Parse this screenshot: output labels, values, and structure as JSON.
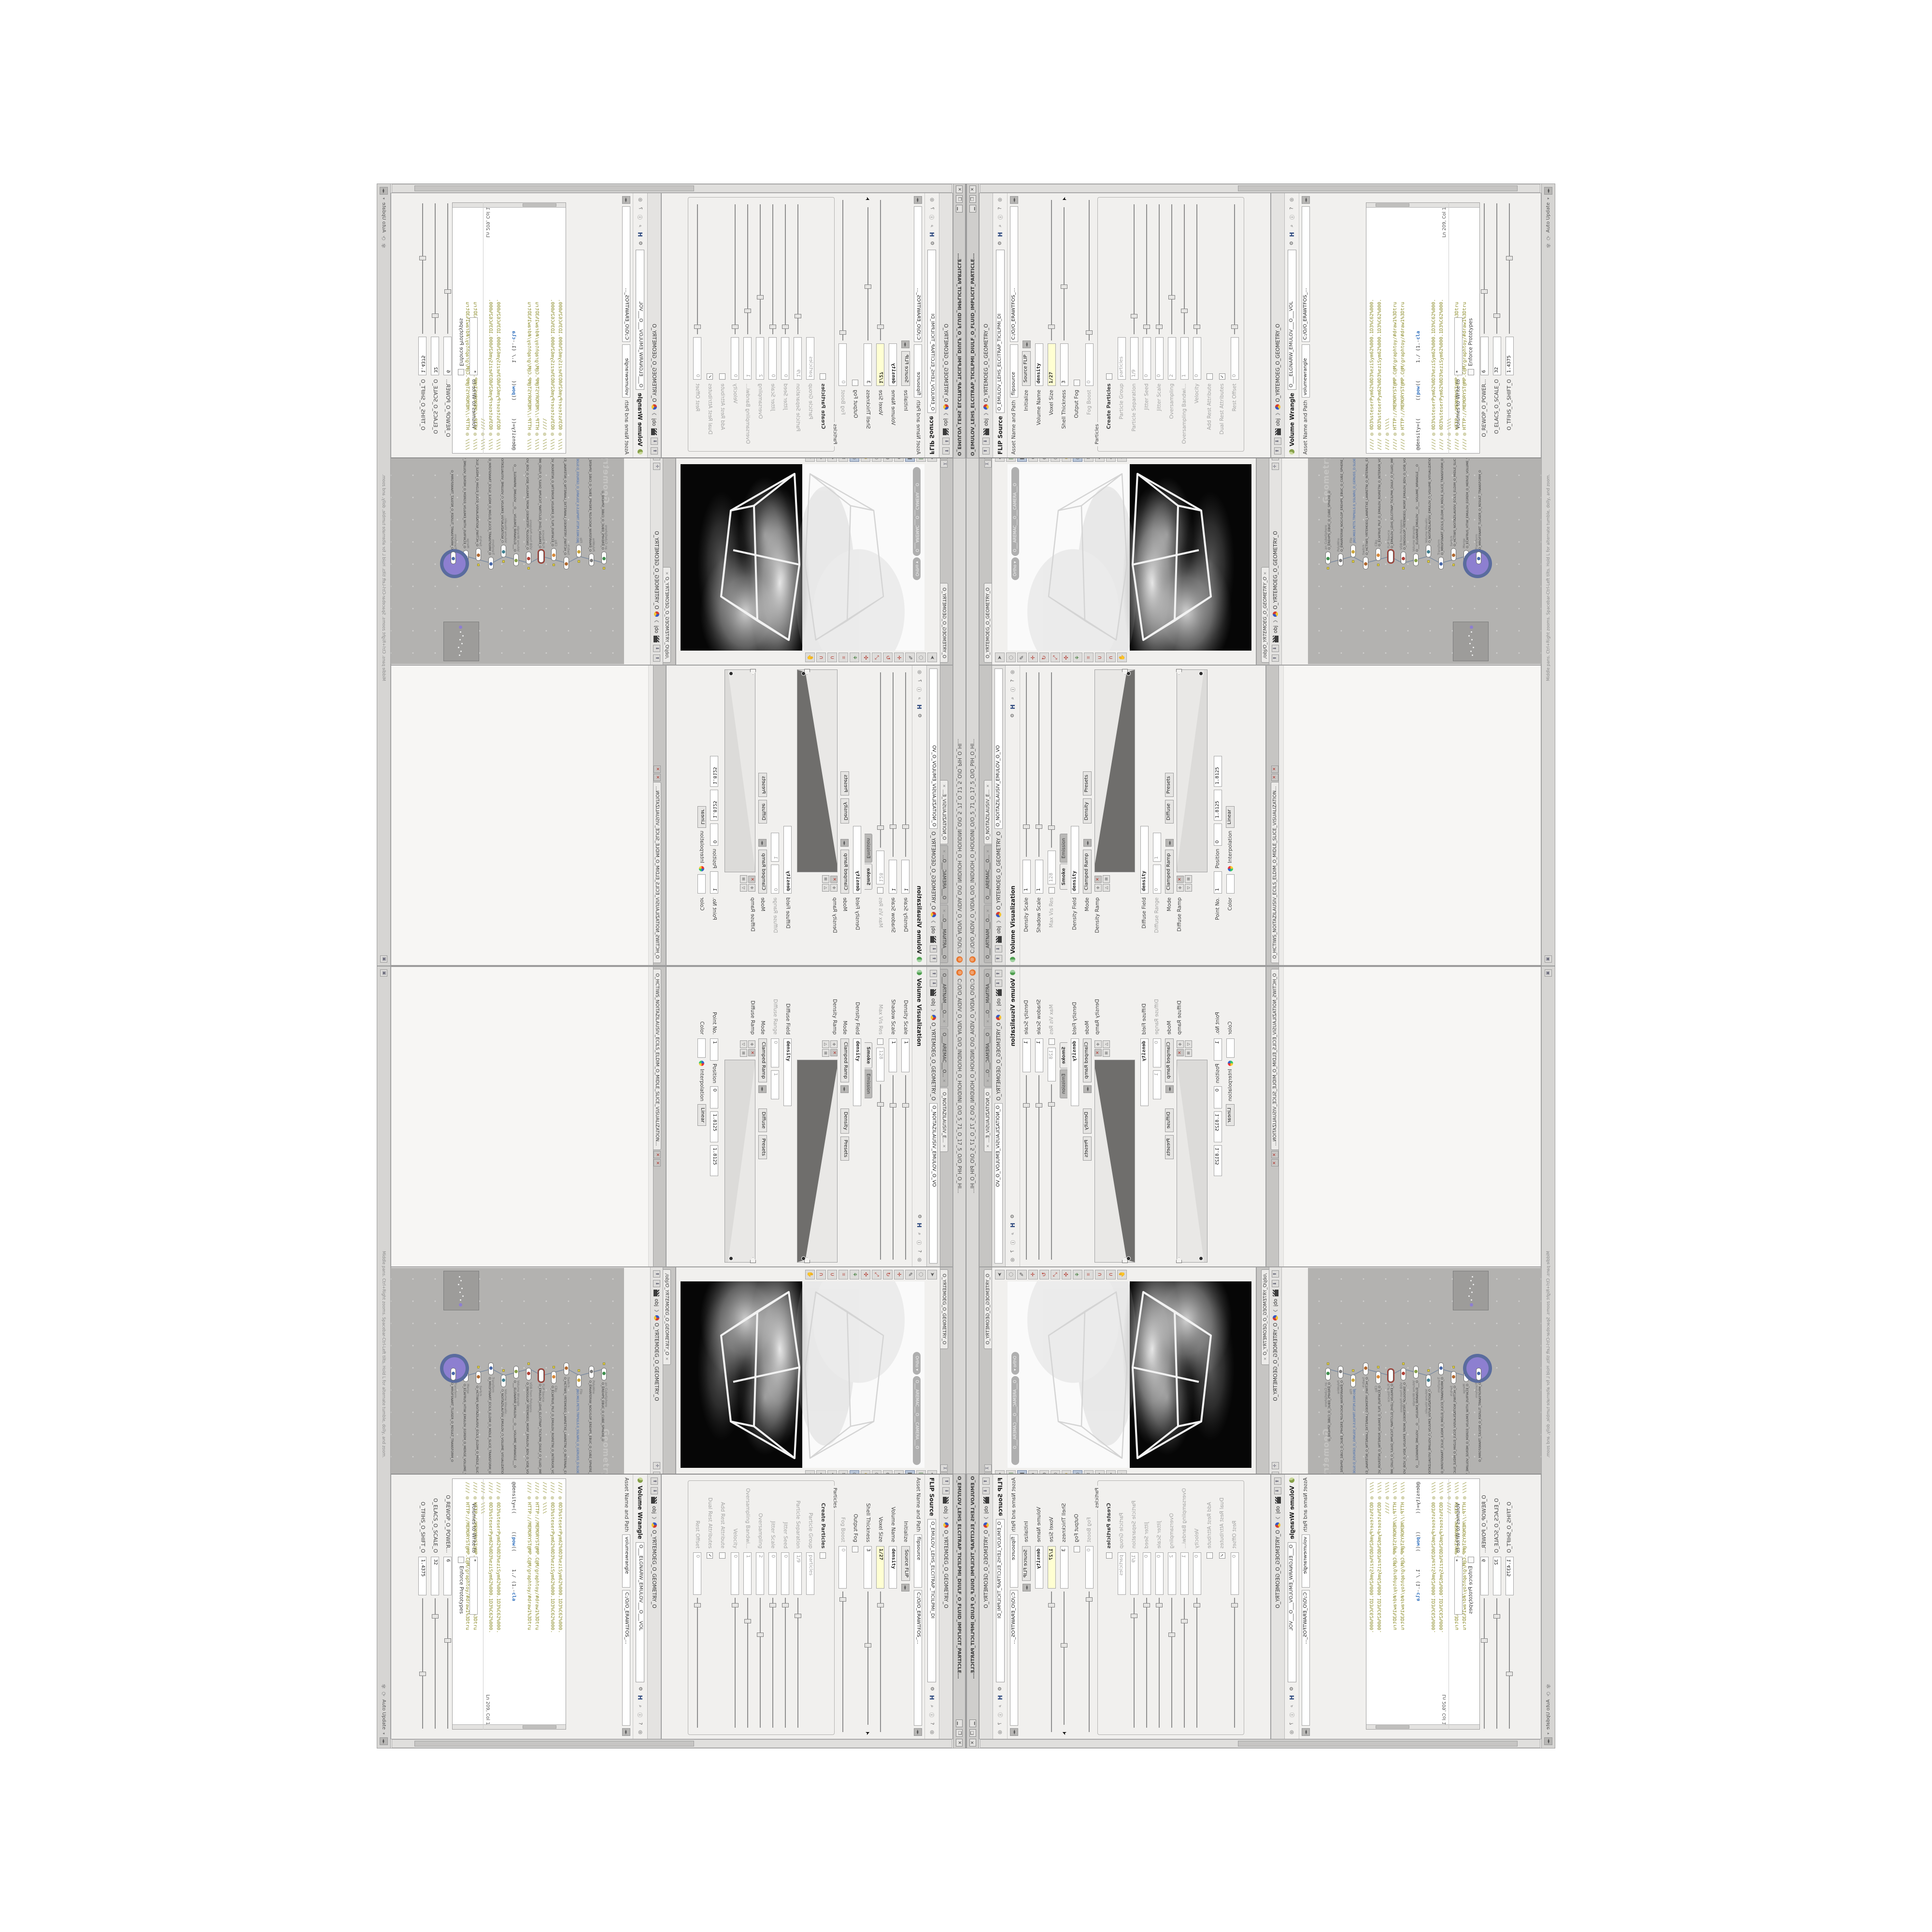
{
  "window": {
    "title_path": "C:/O/O_AIDIV_O_VIDIA_O/O_INIDUOH_O_HOUDINI_O/O_5_71_O_17_5_O/O_PIH_O_HI...",
    "float_title": "O_EMULOV_LEHS_ELCITRAP_TICILPMI_DIULF_O_FLUID_IMPLICIT_PARTICLE...",
    "minimize_glyph": "▁",
    "restore_glyph": "❐",
    "close_glyph": "✕"
  },
  "left_pane": {
    "tabs": [
      "O___ARTNAM___O...",
      "O___AREMAC___O...",
      "O_NOITAZILAUSIV_E..."
    ],
    "breadcrumb_root": "obj",
    "breadcrumb_path": "O_YRTEMOEG_O_GEOMETRY_O",
    "node_field": "O_NOITAZILAUSIV_EMULOV_O_VO",
    "title": "Volume Visualization",
    "density_scale_label": "Density Scale",
    "density_scale": "1",
    "shadow_scale_label": "Shadow Scale",
    "shadow_scale": "1",
    "max_vis_label": "Max Vis Res",
    "max_vis": "128",
    "mode_tab_smoke": "Smoke",
    "mode_tab_emission": "Emission",
    "density_field_label": "Density Field",
    "density_field": "density",
    "mode_label": "Mode",
    "mode_value": "Clamped Ramp",
    "density_sel": "Density",
    "presets_label": "Presets",
    "density_ramp_label": "Density Ramp",
    "diffuse_field_label": "Diffuse Field",
    "diffuse_field": "density",
    "diffuse_range_label": "Diffuse Range",
    "diffuse_range_min": "0",
    "diffuse_range_max": "1",
    "mode2_value": "Clamped Ramp",
    "diffuse_sel": "Diffuse",
    "diffuse_ramp_label": "Diffuse Ramp",
    "point_no_label": "Point No.",
    "point_no": "1",
    "position_label": "Position",
    "position": "0",
    "color_label": "Color",
    "interp_label": "Interpolation",
    "interp": "Linear",
    "val_a": "1.8125",
    "val_b": "1.8125",
    "lower_tab": "O_HCTIWS_NOITAZILAUSIV_ECILS_ELDIM_O_MIDLE_SLICE_VISUALIZATION..."
  },
  "viewport": {
    "tab": "O_YRTEMOEG_O_GEOMETRY_O",
    "ortho": "Ortho",
    "camera": "O___AREMAC___O___CAMERA___O",
    "left_toolbar": [
      {
        "n": "select-arrow-icon",
        "g": "➤",
        "c": ""
      },
      {
        "n": "lasso-select-icon",
        "g": "◌",
        "c": ""
      },
      {
        "n": "brush-select-icon",
        "g": "✎",
        "c": ""
      },
      {
        "n": "translate-icon",
        "g": "✛",
        "c": "red"
      },
      {
        "n": "rotate-icon",
        "g": "↻",
        "c": "red"
      },
      {
        "n": "scale-icon",
        "g": "⤢",
        "c": "red"
      },
      {
        "n": "pose-icon",
        "g": "✣",
        "c": "red"
      },
      {
        "n": "axis-icon",
        "g": "⚘",
        "c": "grn"
      },
      {
        "n": "snap-grid-icon",
        "g": "⌗",
        "c": "red"
      },
      {
        "n": "snap-point-icon",
        "g": "∪",
        "c": "red"
      },
      {
        "n": "snap-edge-icon",
        "g": "∩",
        "c": "red"
      },
      {
        "n": "view-tool-icon",
        "g": "✋",
        "c": ""
      }
    ],
    "right_toolbar": [
      {
        "n": "layout-icon",
        "g": "◆",
        "c": ""
      },
      {
        "n": "snapshot-icon",
        "g": "▣",
        "c": "grn"
      },
      {
        "n": "lock-camera-icon",
        "g": "◧",
        "c": "sel"
      },
      {
        "n": "no-shadows-icon",
        "g": "⊗",
        "c": ""
      },
      {
        "n": "smooth-shade-icon",
        "g": "◍",
        "c": ""
      },
      {
        "n": "headlight-icon",
        "g": "○",
        "c": ""
      },
      {
        "n": "highquality-light-icon",
        "g": "⊕",
        "c": "yel"
      },
      {
        "n": "display-objects-icon",
        "g": "◉",
        "c": "sel"
      },
      {
        "n": "display-points-icon",
        "g": "✱",
        "c": ""
      },
      {
        "n": "display-handles-icon",
        "g": "❖",
        "c": ""
      },
      {
        "n": "display-wire-icon",
        "g": "◇",
        "c": ""
      },
      {
        "n": "visualizers-icon",
        "g": "✦",
        "c": ""
      }
    ]
  },
  "network": {
    "tab": "/obj/O_YRTEMOEG_O_GEOMETRY_O",
    "root": "obj",
    "path": "O_YRTEMOEG_O_GEOMETRY_O",
    "watermark": "Geometry",
    "help": "Middle pans. Ctrl+Right zooms. Spacebar-Ctrl-Left tilts. Hold L for alternate tumble, dolly, and zoom.",
    "nodes": [
      {
        "t": "an_CubeSphere",
        "n": "O_EREHPS_EBUC_O_CUBE_SPHERE_O",
        "ic": "#3f8f4f"
      },
      {
        "t": "PolyWire",
        "n": "O_EMARFERIW_NOGYLOP_EREHPS_EBUC_O_CUBE_SPHERE_POLYGON_WIREFRAME_O",
        "ic": "#7a7a7a"
      },
      {
        "t": "File",
        "n": "JBO.M03.PETS.TRP0/LS.0_SSLNRG_O_GERUSS_D.SLOEPT.STEP.3DVA.OBJ",
        "ic": "#caa53c",
        "blue": true
      },
      {
        "t": "Switch",
        "n": "O_HCTIWS_YRTEMOEG_LANRETXE_LANRETNI_O_INTERNAL_EXTERNAL_GEOMETRY_S...",
        "ic": "#b0682f"
      },
      {
        "t": "CBg",
        "n": "O_ECAFRUS_PILF_O_EMULOV_ROIRETNI_O_INTERIOR_VOLUME_O",
        "ic": "#d8893a"
      },
      {
        "t": "FLIP Source",
        "n": "O_EMULOV_LEHS_ELCITRAP_TICILPMI_DIULF_O_FLUID_IMPLICIT_PARTICLE_SH...",
        "ic": "#ffffff",
        "ring": true
      },
      {
        "t": "VDB from Polygons",
        "n": "O_SNOGILOP_YRTEMOEG_MORF_EMULOV_BDV_O_VDB_VOLUME_FROM_GEOME...",
        "ic": "#b04038"
      },
      {
        "t": "Volume Wrangle",
        "n": "O___ELGNARW_EMULOV___O___VOLUME_WRANGLE___O",
        "ic": "#86a048"
      },
      {
        "t": "Volume Visualiz...",
        "n": "O_NOITAZILAUSIV_EMULOV_O_VOLUME_VISUALIZATION_O",
        "ic": "#3f7f8f"
      },
      {
        "t": "Transform",
        "n": "O_MROFSNART_ECILS_ELDIM_O_MIDLE_SLICE_TRANSFORM_O",
        "ic": "#4868a8"
      },
      {
        "t": "Switch",
        "n": "O_HCTIWS_NOITAZILAUSIV_ECILS_ELDIM_O_MIDLE_SLICE_VISUALIZATION_SWI...",
        "ic": "#b0682f"
      },
      {
        "t": "Merge",
        "n": "O_ECAFRUS_HTIW_EMULOV_EGREM_O_MERGE_VOLUME_WITH_SURFACE_O",
        "ic": "#8f8f8f"
      },
      {
        "t": "Transform",
        "n": "O_MROFSNART_TLUSER_O_RESULT_TRANSFORM_O",
        "ic": "#4868a8",
        "halo": true
      }
    ]
  },
  "flip_pane": {
    "tab_title": "FLIP Source",
    "name_field": "O_EMULOV_LEHS_ELCITRAP_TICILPMI_DI",
    "breadcrumb_root": "obj",
    "breadcrumb_path": "O_YRTEMOEG_O_GEOMETRY_O",
    "asset_label": "Asset Name and Path",
    "asset_name": "flipsource",
    "asset_path": "C:/O/O_ERAWTFOS_...",
    "rows": [
      {
        "label": "Initialize",
        "type": "dropdown",
        "value": "Source FLIP"
      },
      {
        "label": "Volume Name",
        "type": "field-bold",
        "value": "density"
      },
      {
        "label": "Voxel Size",
        "type": "field-slider",
        "value": "1/27",
        "highlight": true,
        "pos": 8
      },
      {
        "label": "Shell Thickness",
        "type": "field-slider",
        "value": "3",
        "pos": 38,
        "cursor": true
      },
      {
        "label": "Output Fog",
        "type": "check",
        "checked": false
      },
      {
        "label": "Fog Boost",
        "type": "field-slider",
        "value": "0",
        "dim": true,
        "pos": 4
      },
      {
        "label": "Particles",
        "type": "group"
      },
      {
        "label": "Create Particles",
        "type": "check",
        "bold": true,
        "checked": false
      },
      {
        "label": "Particle Group",
        "type": "field",
        "value": "particles",
        "dim": true
      },
      {
        "label": "Particle Separation",
        "type": "field-slider",
        "value": "1/9",
        "dim": true,
        "pos": 12
      },
      {
        "label": "Jitter Seed",
        "type": "field-slider",
        "value": "0",
        "dim": true,
        "pos": 4
      },
      {
        "label": "Jitter Scale",
        "type": "field-slider",
        "value": "0",
        "dim": true,
        "pos": 4
      },
      {
        "label": "Oversampling",
        "type": "field-slider",
        "value": "2",
        "dim": true,
        "pos": 26
      },
      {
        "label": "Oversampling Bandwi...",
        "type": "field-slider",
        "value": "1",
        "dim": true,
        "pos": 16
      },
      {
        "label": "Velocity",
        "type": "field-slider",
        "value": "0",
        "dim": true,
        "pos": 4
      },
      {
        "label": "Add Rest Attribute",
        "type": "check",
        "dim": true,
        "checked": false
      },
      {
        "label": "Dual Rest Attributes",
        "type": "check",
        "dim": true,
        "checked": true
      },
      {
        "label": "Rest Offset",
        "type": "field-slider",
        "value": "0",
        "dim": true,
        "pos": 4
      }
    ]
  },
  "wrangle_pane": {
    "tab_title": "Volume Wrangle",
    "name_field": "O___ELGNARW_EMULOV___O___VOL",
    "breadcrumb_root": "obj",
    "breadcrumb_path": "O_YRTEMOEG_O_GEOMETRY_O",
    "asset_label": "Asset Name and Path",
    "asset_name": "volumewrangle",
    "asset_path": "C:/O/O_ERAWTFOS_...",
    "code_lines": [
      "//// ◎ 0D3%steserPym62%0D3%eziSym62%000.1D3%C62%000.",
      "//// ◎ 0D3%steserPym62%0D3%eziSym62%000.1D3%C62%000.",
      "//// ◎ \\\\\\\\",
      "//// ◎ HTTP://MEMORYST@MP.C@M/graphtoy/#draw1%3Dtru",
      "//// ◎ HTTP://MEMORYST@MP.C@M/graphtoy/#draw1%3Dtru",
      "",
      "@density=((      ((pow((      1./ (1.-cla",
      "",
      "//// ◎ 0D3%steserPym62%0D3%eziSym62%000.1D3%C62%000.",
      "//// ◎ 0D3%steserPym62%0D3%eziSym62%000.1D3%C62%000.",
      "//// ◎ \\\\\\\\",
      "//// ◎ HTTP://MEMORYST@MP.C@M/graphtoy/#draw1%3Dtru",
      "//// ◎ HTTP://MEMORYST@MP.C@M/graphtoy/#draw1%3Dtru"
    ],
    "ln_status": "Ln 209, Col 1",
    "volumes_label": "Volumes to Write to",
    "volumes_value": "*",
    "enforce_label": "Enforce Prototypes",
    "sliders": [
      {
        "label": "O_REWOP_O_POWER...",
        "value": "6",
        "pos": 30
      },
      {
        "label": "O_ELACS_O_SCALE_O",
        "value": "32",
        "pos": 12
      },
      {
        "label": "O_TFIHS_O_SHIFT_O",
        "value": "1.4375",
        "pos": 55
      }
    ]
  },
  "status": {
    "auto_update": "Auto Update",
    "refresh_glyph": "⟳",
    "memory_glyph": "✾"
  },
  "colors": {
    "accent_yellow_field": "#ffffd2",
    "node_halo_purple": "#8d7fd0",
    "node_halo_ring": "#5a6c9e",
    "code_comment_olive": "#8c8c2a",
    "code_keyword_blue": "#2f6fbd",
    "network_canvas": "#b3b2b0",
    "red_close": "#b03028"
  }
}
